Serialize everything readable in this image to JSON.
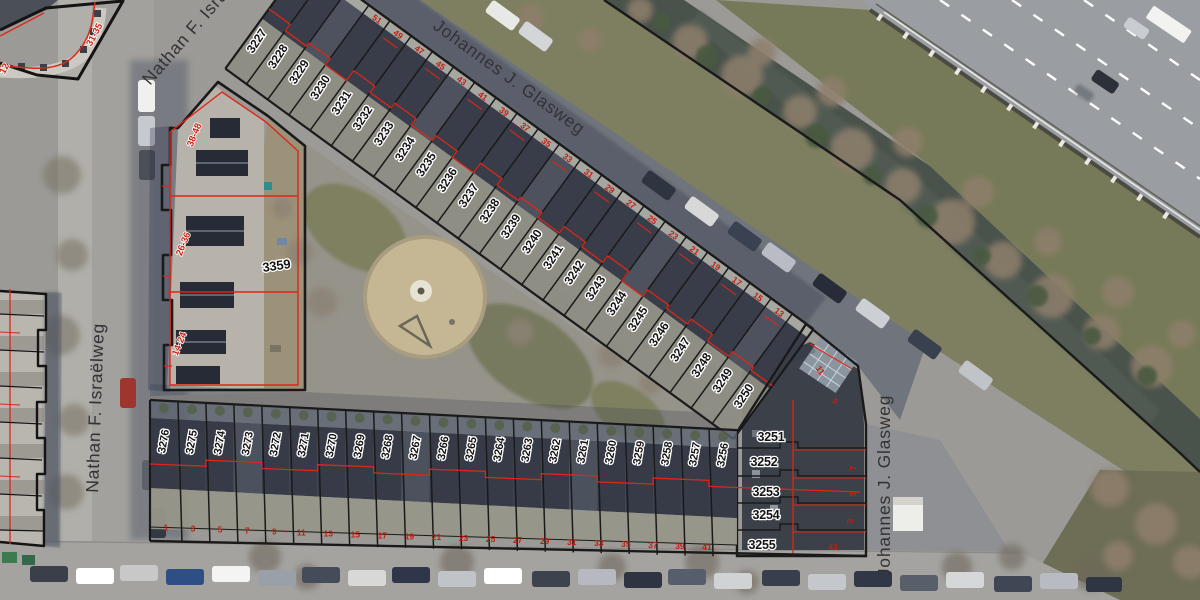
{
  "map": {
    "streets": [
      {
        "id": "johannes-top",
        "name": "Johannes J. Glasweg",
        "x": 432,
        "y": 28,
        "rot": 36,
        "size": 17.5,
        "anchor": "start"
      },
      {
        "id": "johannes-right",
        "name": "Johannes J. Glasweg",
        "x": 890,
        "y": 486,
        "rot": -90,
        "size": 17.5,
        "anchor": "middle"
      },
      {
        "id": "nathan-left",
        "name": "Nathan F. Israëlweg",
        "x": 101,
        "y": 408,
        "rot": -88,
        "size": 17.5,
        "anchor": "middle"
      },
      {
        "id": "nathan-top",
        "name": "Nathan F. Israëlweg",
        "x": 150,
        "y": 86,
        "rot": -49,
        "size": 17.5,
        "anchor": "start"
      }
    ],
    "blocks": {
      "ne_row": {
        "parcels": [
          {
            "id": "3227",
            "house": "57"
          },
          {
            "id": "3228",
            "house": "55"
          },
          {
            "id": "3229",
            "house": "53"
          },
          {
            "id": "3230",
            "house": "51"
          },
          {
            "id": "3231",
            "house": "49"
          },
          {
            "id": "3232",
            "house": "47"
          },
          {
            "id": "3233",
            "house": "45"
          },
          {
            "id": "3234",
            "house": "43"
          },
          {
            "id": "3235",
            "house": "41"
          },
          {
            "id": "3236",
            "house": "39"
          },
          {
            "id": "3237",
            "house": "37"
          },
          {
            "id": "3238",
            "house": "35"
          },
          {
            "id": "3239",
            "house": "33"
          },
          {
            "id": "3240",
            "house": "31"
          },
          {
            "id": "3241",
            "house": "29"
          },
          {
            "id": "3242",
            "house": "27"
          },
          {
            "id": "3243",
            "house": "25"
          },
          {
            "id": "3244",
            "house": "23"
          },
          {
            "id": "3245",
            "house": "21"
          },
          {
            "id": "3246",
            "house": "19"
          },
          {
            "id": "3247",
            "house": "17"
          },
          {
            "id": "3248",
            "house": "15"
          },
          {
            "id": "3249",
            "house": "13"
          },
          {
            "id": "3250",
            "house": "11"
          }
        ]
      },
      "east_column": {
        "parcels": [
          {
            "id": "3251",
            "house": "9",
            "lx": 771,
            "ly": 441
          },
          {
            "id": "3252",
            "house": "7",
            "lx": 764,
            "ly": 466
          },
          {
            "id": "3253",
            "house": "5",
            "lx": 766,
            "ly": 496
          },
          {
            "id": "3254",
            "house": "3",
            "lx": 766,
            "ly": 519
          },
          {
            "id": "3255",
            "house": "43",
            "lx": 762,
            "ly": 549
          }
        ],
        "extra_house_numbers": [
          {
            "t": "9",
            "x": 833,
            "y": 403,
            "rot": 55
          },
          {
            "t": "7",
            "x": 856,
            "y": 468,
            "rot": -90
          },
          {
            "t": "5",
            "x": 856,
            "y": 494,
            "rot": -90
          },
          {
            "t": "3",
            "x": 853,
            "y": 521,
            "rot": -90
          },
          {
            "t": "43",
            "x": 833,
            "y": 550,
            "rot": 0
          }
        ]
      },
      "south_row": {
        "parcels": [
          {
            "id": "3276",
            "house": "1"
          },
          {
            "id": "3275",
            "house": "3"
          },
          {
            "id": "3274",
            "house": "5"
          },
          {
            "id": "3273",
            "house": "7"
          },
          {
            "id": "3272",
            "house": "9"
          },
          {
            "id": "3271",
            "house": "11"
          },
          {
            "id": "3270",
            "house": "13"
          },
          {
            "id": "3269",
            "house": "15"
          },
          {
            "id": "3268",
            "house": "17"
          },
          {
            "id": "3267",
            "house": "19"
          },
          {
            "id": "3266",
            "house": "21"
          },
          {
            "id": "3265",
            "house": "23"
          },
          {
            "id": "3264",
            "house": "25"
          },
          {
            "id": "3263",
            "house": "27"
          },
          {
            "id": "3262",
            "house": "29"
          },
          {
            "id": "3261",
            "house": "31"
          },
          {
            "id": "3260",
            "house": "33"
          },
          {
            "id": "3259",
            "house": "35"
          },
          {
            "id": "3258",
            "house": "37"
          },
          {
            "id": "3257",
            "house": "39"
          },
          {
            "id": "3256",
            "house": "41"
          }
        ]
      },
      "west_block": {
        "id": "3359",
        "label_x": 277,
        "label_y": 270,
        "label_rot": -8,
        "range_labels": [
          {
            "t": "38-48",
            "x": 197,
            "y": 136,
            "rot": -68
          },
          {
            "t": "26-36",
            "x": 186,
            "y": 245,
            "rot": -68
          },
          {
            "t": "14-24",
            "x": 182,
            "y": 345,
            "rot": -68
          }
        ]
      },
      "northwest_block": {
        "range_labels": [
          {
            "t": "31-35",
            "x": 97,
            "y": 36,
            "rot": -62
          },
          {
            "t": "12",
            "x": 7,
            "y": 70,
            "rot": -62
          }
        ]
      }
    },
    "colors": {
      "cadastral_black": "#1a1a1a",
      "cadastral_red": "#dc2718",
      "house_number_red": "#c21e10",
      "label_fill": "#141414",
      "label_halo": "#ffffff",
      "asphalt": "#70757d",
      "asphalt_shadow": "#565d6a",
      "pavement": "#a6a4a0",
      "roof_dark": "#383d49",
      "roof_mid": "#4a505c",
      "grass": "#7d7f60",
      "water": "#49524b",
      "tree_brown": "#8f7f6c",
      "shrub_green": "#4a5a3f",
      "sand": "#c6b794",
      "highway": "#9a9da1"
    }
  }
}
